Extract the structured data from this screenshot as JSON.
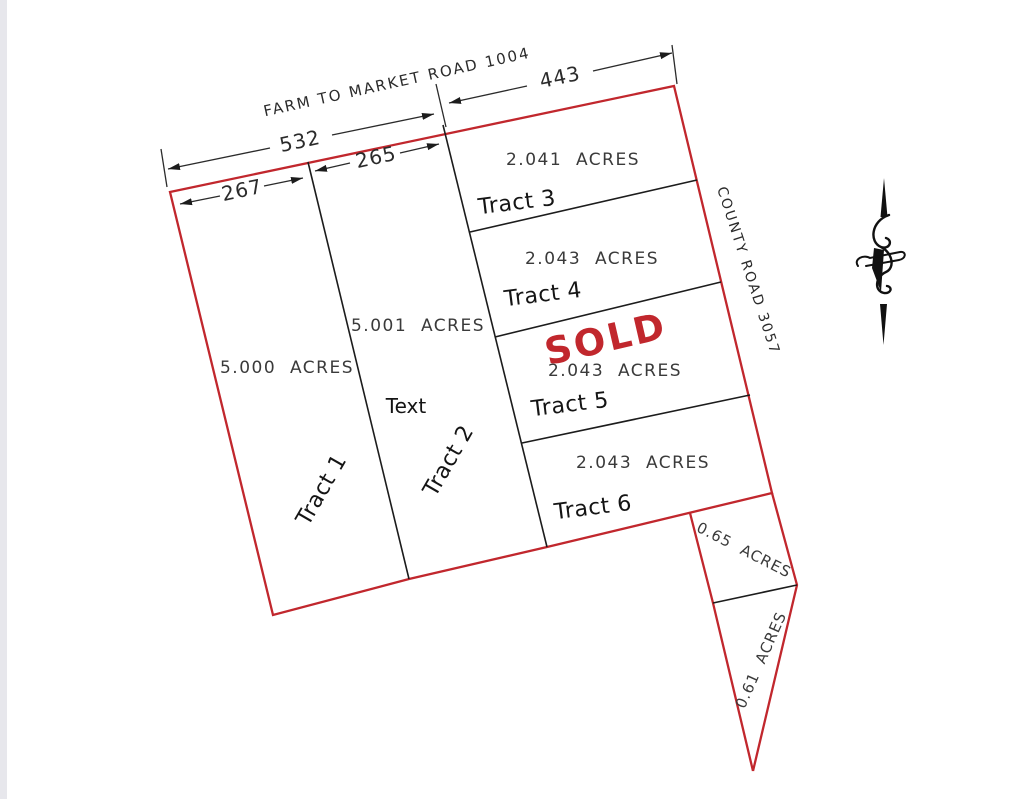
{
  "colors": {
    "boundary_red": "#c1272d",
    "line_black": "#1c1c1c",
    "sold_red": "#c1272d"
  },
  "roads": {
    "top_road": "FARM TO MARKET ROAD 1004",
    "side_road": "COUNTY ROAD 3057"
  },
  "dimensions": {
    "frontage_full": "532",
    "frontage_right": "443",
    "frontage_mid": "265",
    "frontage_left": "267"
  },
  "tracts": [
    {
      "name": "Tract 1",
      "acres": "5.000  ACRES"
    },
    {
      "name": "Tract 2",
      "acres": "5.001  ACRES",
      "note": "Text"
    },
    {
      "name": "Tract 3",
      "acres": "2.041  ACRES"
    },
    {
      "name": "Tract 4",
      "acres": "2.043  ACRES"
    },
    {
      "name": "Tract 5",
      "acres": "2.043  ACRES",
      "status": "SOLD"
    },
    {
      "name": "Tract 6",
      "acres": "2.043  ACRES"
    },
    {
      "acres": "0.65  ACRES"
    },
    {
      "acres": "0.61  ACRES"
    }
  ],
  "compass": {
    "label": "north-arrow"
  }
}
